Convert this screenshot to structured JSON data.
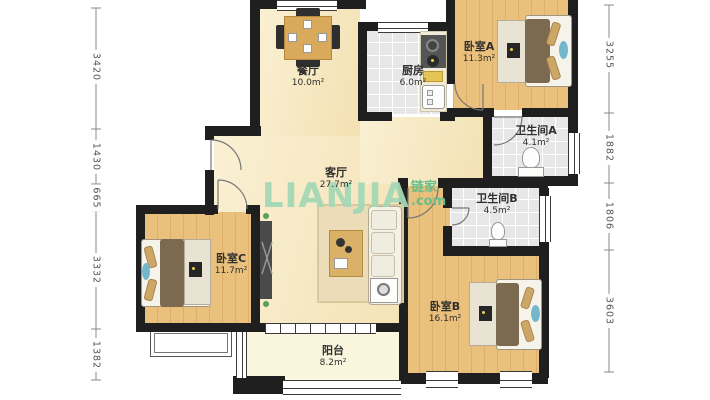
{
  "watermark": {
    "brand": "LIANJIA",
    "brand_cn": "链家",
    "brand_suffix": ".com"
  },
  "rooms": {
    "dining": {
      "name": "餐厅",
      "area": "10.0m²"
    },
    "kitchen": {
      "name": "厨房",
      "area": "6.0m²"
    },
    "bedroom_a": {
      "name": "卧室A",
      "area": "11.3m²"
    },
    "bathroom_a": {
      "name": "卫生间A",
      "area": "4.1m²"
    },
    "living": {
      "name": "客厅",
      "area": "27.7m²"
    },
    "bathroom_b": {
      "name": "卫生间B",
      "area": "4.5m²"
    },
    "bedroom_c": {
      "name": "卧室C",
      "area": "11.7m²"
    },
    "bedroom_b": {
      "name": "卧室B",
      "area": "16.1m²"
    },
    "balcony": {
      "name": "阳台",
      "area": "8.2m²"
    }
  },
  "dimensions_mm": {
    "left": [
      "3420",
      "1430",
      "665",
      "3332",
      "1382"
    ],
    "right": [
      "3255",
      "1882",
      "1806",
      "3603"
    ]
  },
  "colors": {
    "wall": "#1f1f1f",
    "wood_floor": "#e9c07c",
    "pale_floor": "#f7e9c0",
    "tile_floor": "#e7e7e7",
    "balcony_floor": "#faf6de",
    "watermark_green": "#a3d7b4",
    "watermark_green_dark": "#68bd8b"
  }
}
